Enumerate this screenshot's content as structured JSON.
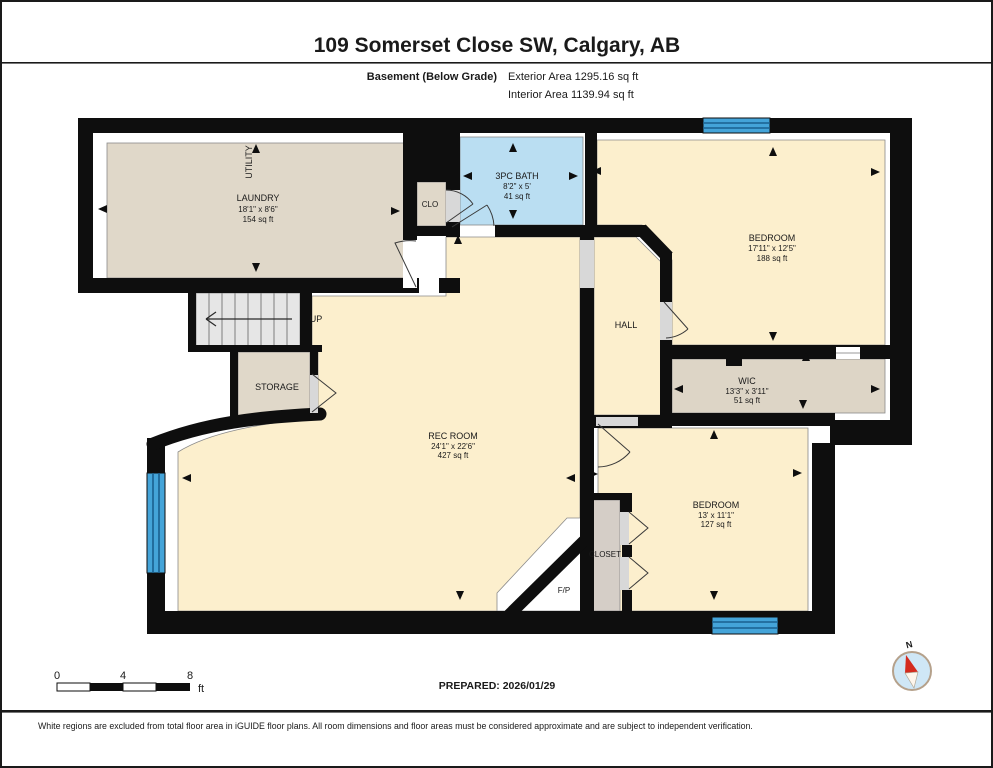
{
  "header": {
    "title": "109 Somerset Close SW, Calgary, AB",
    "floor_label": "Basement (Below Grade)",
    "exterior_area": "Exterior Area 1295.16 sq ft",
    "interior_area": "Interior Area 1139.94 sq ft"
  },
  "rooms": {
    "laundry": {
      "name": "LAUNDRY",
      "dims": "18'1\" x 8'6\"",
      "area": "154 sq ft"
    },
    "utility": {
      "name": "UTILITY"
    },
    "clo": {
      "name": "CLO"
    },
    "bath": {
      "name": "3PC BATH",
      "dims": "8'2\" x 5'",
      "area": "41 sq ft"
    },
    "bedroom1": {
      "name": "BEDROOM",
      "dims": "17'11\" x 12'5\"",
      "area": "188 sq ft"
    },
    "hall": {
      "name": "HALL"
    },
    "wic": {
      "name": "WIC",
      "dims": "13'3\" x 3'11\"",
      "area": "51 sq ft"
    },
    "storage": {
      "name": "STORAGE"
    },
    "rec": {
      "name": "REC ROOM",
      "dims": "24'1\" x 22'6\"",
      "area": "427 sq ft"
    },
    "bedroom2": {
      "name": "BEDROOM",
      "dims": "13' x 11'1\"",
      "area": "127 sq ft"
    },
    "closet": {
      "name": "CLOSET"
    },
    "fp": {
      "name": "F/P"
    },
    "up": {
      "name": "UP"
    }
  },
  "scale": {
    "ticks": [
      "0",
      "4",
      "8"
    ],
    "unit": "ft"
  },
  "footer": {
    "prepared": "PREPARED: 2026/01/29",
    "disclaimer": "White regions are excluded from total floor area in iGUIDE floor plans. All room dimensions and floor areas must be considered approximate and are subject to independent verification."
  },
  "compass": {
    "north_label": "N"
  },
  "colors": {
    "wall": "#0e0e0e",
    "room_cream": "#fcefcd",
    "room_beige": "#e0d8c9",
    "room_bath_blue": "#badef2",
    "window_blue": "#44a4d9",
    "stairs_gray": "#e6e6e6",
    "closet_gray": "#d5cec7",
    "compass_needle_red": "#d42b1e"
  }
}
